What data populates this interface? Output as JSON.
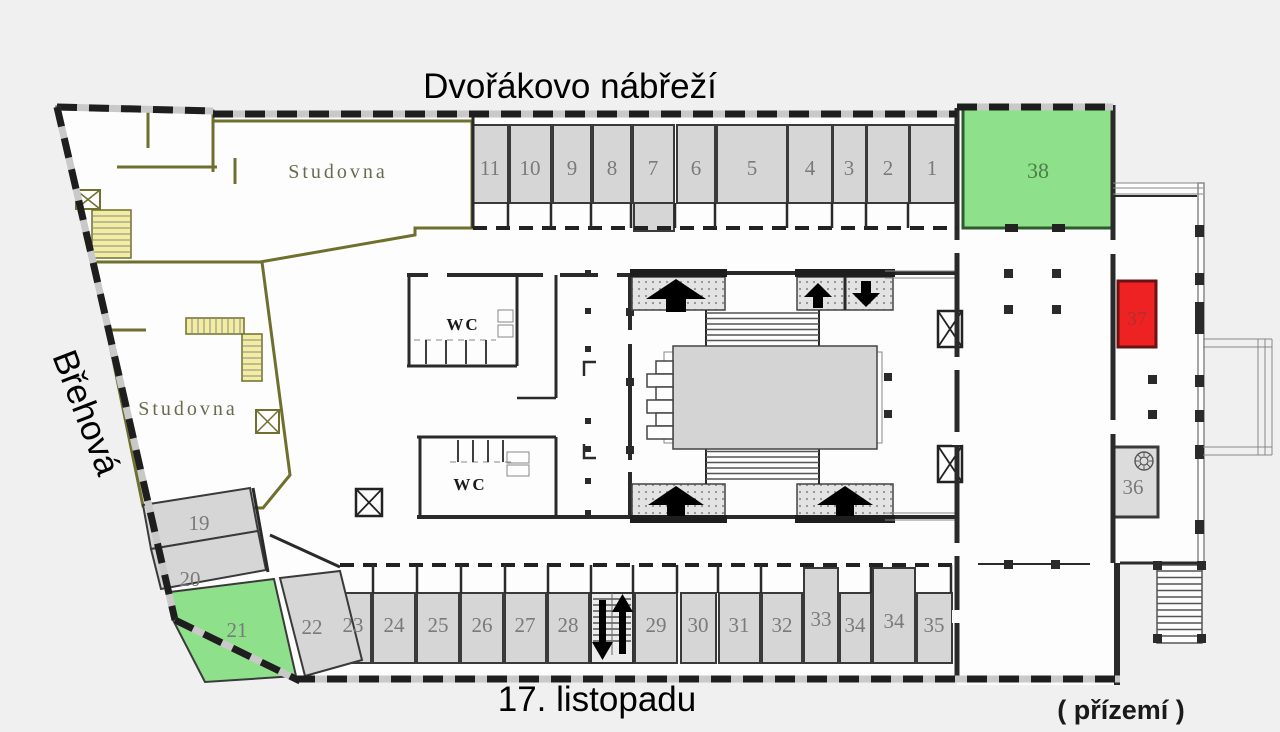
{
  "streets": {
    "top": "Dvořákovo nábřeží",
    "left": "Břehová",
    "bottom": "17. listopadu"
  },
  "floor_label": "( přízemí )",
  "labels": {
    "studovna_upper": "Studovna",
    "studovna_lower": "Studovna",
    "wc_upper": "WC",
    "wc_lower": "WC"
  },
  "rooms": {
    "top_row": [
      "11",
      "10",
      "9",
      "8",
      "7",
      "6",
      "5",
      "4",
      "3",
      "2",
      "1"
    ],
    "west": [
      "19",
      "20",
      "21",
      "22"
    ],
    "south_row": [
      "23",
      "24",
      "25",
      "26",
      "27",
      "28",
      "29",
      "30",
      "31",
      "32",
      "33",
      "34",
      "34",
      "35"
    ],
    "east": {
      "r38": "38",
      "r37": "37",
      "r36": "36"
    }
  },
  "colors": {
    "background": "#f0f0f0",
    "floor": "#fdfdfd",
    "room_gray": "#d6d6d6",
    "studovna_yellow": "#f2eda0",
    "highlight_green": "#8fe08a",
    "highlight_red": "#ee2222",
    "stair_landing": "#e3e3e3",
    "wall": "#1e1e1e"
  }
}
